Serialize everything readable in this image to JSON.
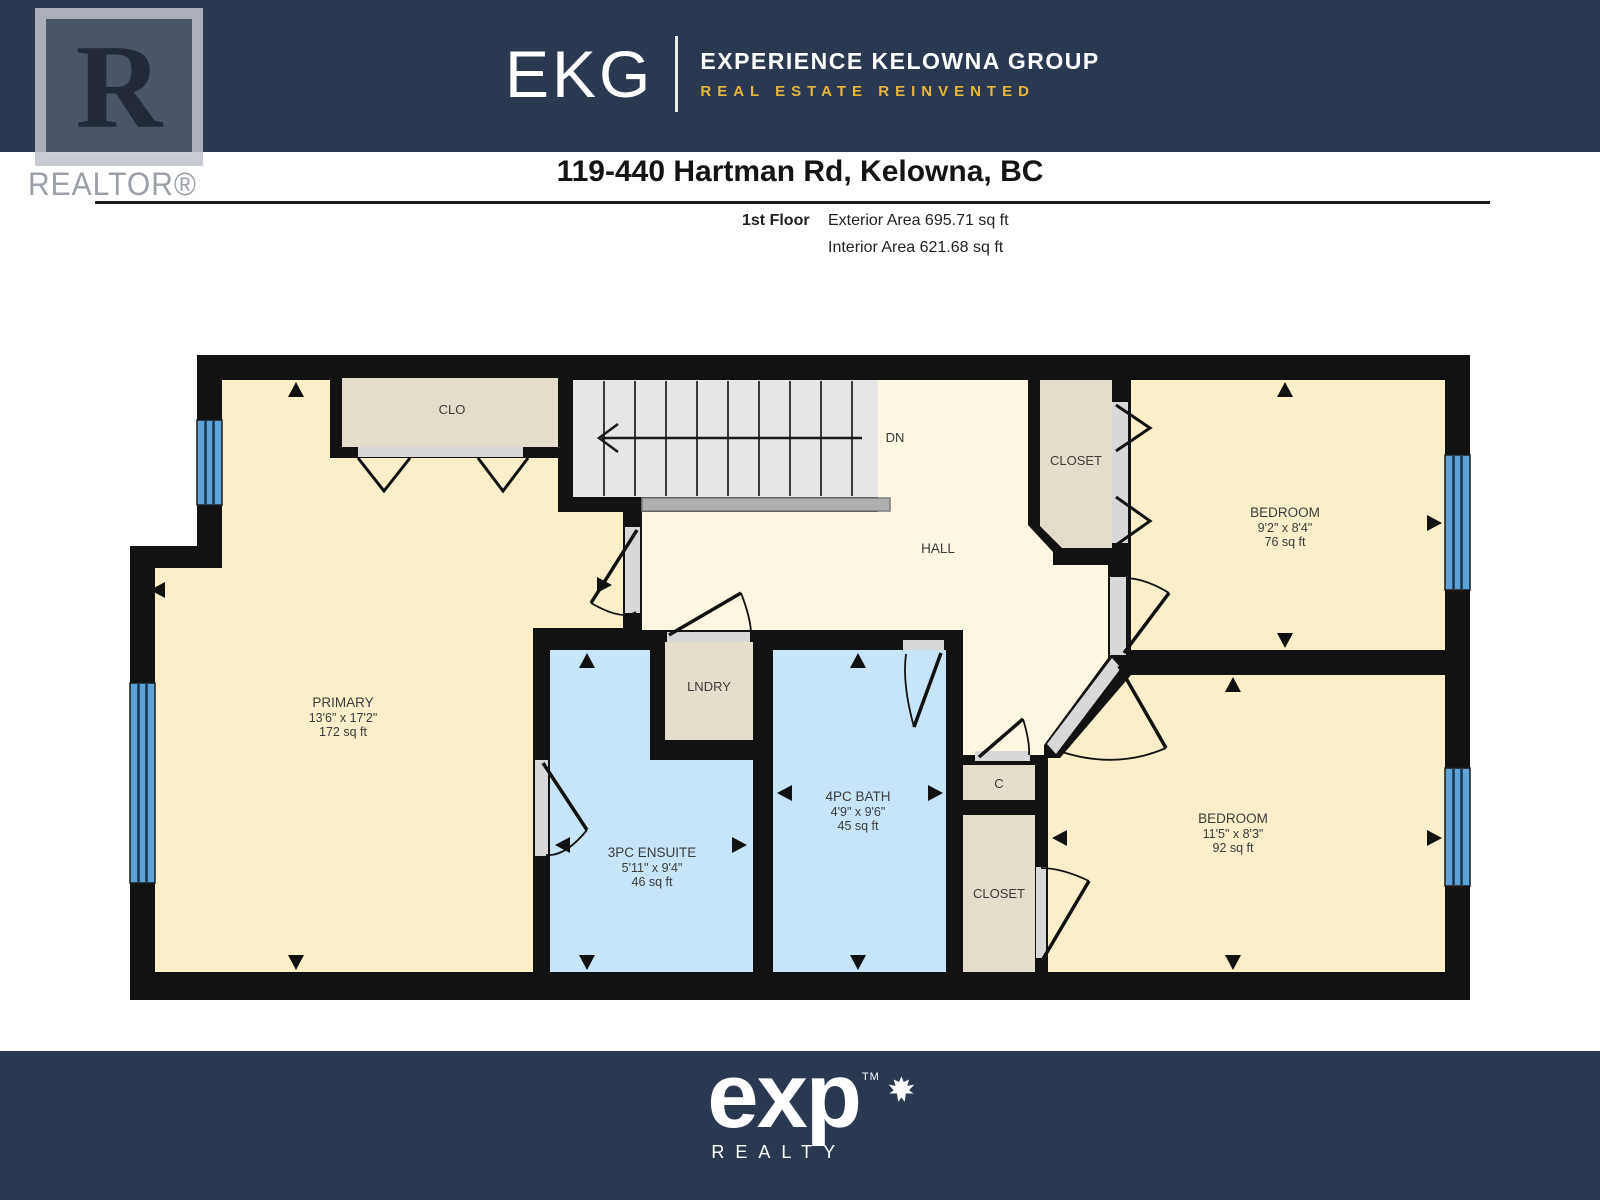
{
  "header": {
    "realtor": {
      "letter": "R",
      "label": "REALTOR®"
    },
    "brand": {
      "abbr": "EKG",
      "name": "EXPERIENCE KELOWNA GROUP",
      "tagline": "REAL ESTATE REINVENTED"
    },
    "address": "119-440 Hartman Rd, Kelowna, BC",
    "floor": {
      "label": "1st Floor",
      "exterior": "Exterior Area 695.71 sq ft",
      "interior": "Interior Area 621.68 sq ft"
    }
  },
  "plan": {
    "rooms": [
      {
        "name": "PRIMARY",
        "dims": "13'6\" x 17'2\"",
        "area": "172 sq ft"
      },
      {
        "name": "BEDROOM",
        "dims": "9'2\" x 8'4\"",
        "area": "76 sq ft"
      },
      {
        "name": "BEDROOM",
        "dims": "11'5\" x 8'3\"",
        "area": "92 sq ft"
      },
      {
        "name": "3PC ENSUITE",
        "dims": "5'11\" x 9'4\"",
        "area": "46 sq ft"
      },
      {
        "name": "4PC BATH",
        "dims": "4'9\" x 9'6\"",
        "area": "45 sq ft"
      }
    ],
    "labels": {
      "clo": "CLO",
      "dn": "DN",
      "hall": "HALL",
      "closet_top": "CLOSET",
      "lndry": "LNDRY",
      "c": "C",
      "closet_bottom": "CLOSET"
    }
  },
  "footer": {
    "brand": "exp",
    "tm": "TM",
    "sub": "REALTY"
  },
  "colors": {
    "header_navy": "#2A3950",
    "gold": "#E7B63C",
    "wall": "#121212",
    "room_floor": "#FAEFC9",
    "hall_floor": "#FCF6E2",
    "bath_floor": "#C8E4F8",
    "closet_floor": "#E5DDCB",
    "stairs": "#E6E6E6",
    "window": "#5BA3D9"
  }
}
